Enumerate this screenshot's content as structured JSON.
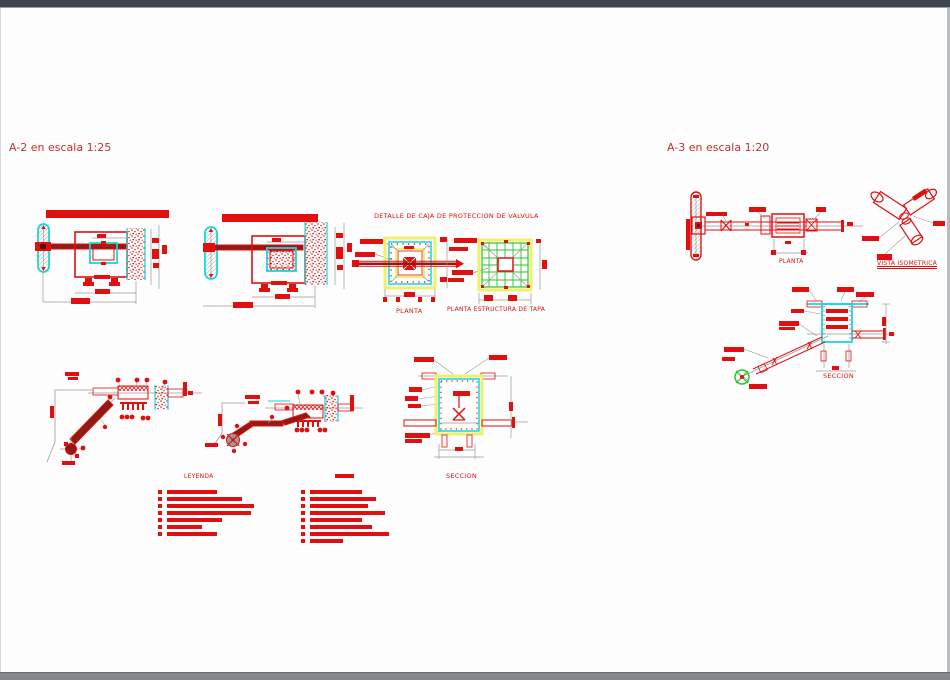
{
  "frame": {
    "top_color": "#3e444c",
    "bottom_color": "#85898d",
    "canvas_color": "#fdfdfd"
  },
  "colors": {
    "red": "#e01010",
    "dark_red": "#8e1b15",
    "cyan": "#15d8d8",
    "yellow": "#f0ef6e",
    "green": "#2fc42f",
    "gray": "#9a9a9a",
    "title_red": "#c23030"
  },
  "titles": {
    "a2": "A-2 en escala 1:25",
    "a3": "A-3 en escala 1:20",
    "detail": "DETALLE DE CAJA DE PROTECCION DE VALVULA"
  },
  "labels": {
    "planta": "PLANTA",
    "planta_estructura": "PLANTA ESTRUCTURA DE TAPA",
    "seccion": "SECCION",
    "leyenda": "LEYENDA",
    "a3_planta": "PLANTA",
    "vista_isometrica": "VISTA ISOMETRICA",
    "a3_seccion": "SECCION"
  },
  "legend": {
    "title": "LEYENDA",
    "left_bar_widths": [
      50,
      75,
      87,
      84,
      55,
      35,
      50
    ],
    "right_bar_widths": [
      52,
      66,
      58,
      75,
      52,
      62,
      79,
      33
    ]
  }
}
